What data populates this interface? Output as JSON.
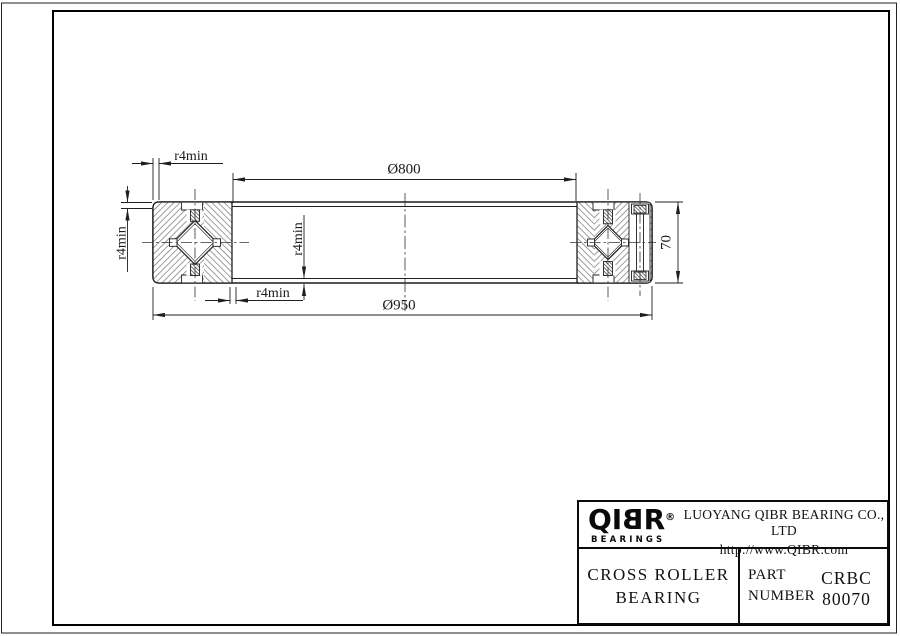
{
  "drawing": {
    "labels": {
      "bore_diameter": "Ø800",
      "outer_diameter": "Ø950",
      "section_width": "70",
      "fillet_top": "r4min",
      "fillet_left": "r4min",
      "fillet_inner": "r4min",
      "fillet_bottom": "r4min"
    },
    "line_color": "#1f1f1f",
    "hatch_color": "#6a6a6a"
  },
  "title_block": {
    "logo": {
      "prefix": "QI",
      "mirrored_letter": "B",
      "suffix": "R",
      "registered": "®",
      "tagline": "BEARINGS"
    },
    "company": "LUOYANG QIBR BEARING CO., LTD",
    "website": "http://www.QIBR.com",
    "product": {
      "line1": "CROSS ROLLER",
      "line2": "BEARING"
    },
    "part": {
      "label_line1": "PART",
      "label_line2": "NUMBER",
      "number": "CRBC 80070"
    }
  }
}
